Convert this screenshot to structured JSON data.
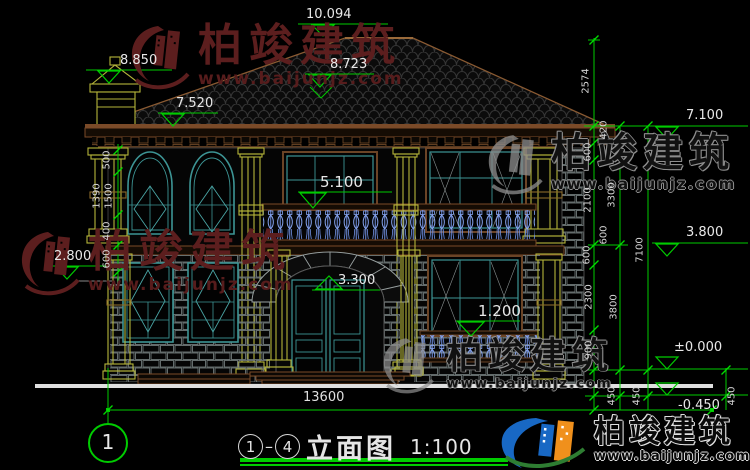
{
  "watermark": {
    "brand": "柏竣建筑",
    "url": "www.baijunjz.com"
  },
  "title": {
    "axis_from": "1",
    "axis_to": "4",
    "separator": "–",
    "name": "立面图",
    "scale": "1:100"
  },
  "axis_bubble": {
    "label": "1"
  },
  "elevations": {
    "ridge": "10.094",
    "chimney": "8.850",
    "roof_right": "8.723",
    "eave": "7.520",
    "balcony": "5.100",
    "arch": "3.300",
    "left_mid": "2.800",
    "window_sill": "1.200",
    "right_eave": "7.100",
    "right_floor2": "3.800",
    "ground": "±0.000",
    "grade": "-0.450"
  },
  "dimensions": {
    "total_width": "13600",
    "right": [
      "2574",
      "420",
      "600",
      "2100",
      "3300",
      "600",
      "7100",
      "600",
      "2300",
      "3800",
      "900",
      "450",
      "450",
      "450"
    ],
    "left": [
      "500",
      "1390",
      "1500",
      "400",
      "600"
    ]
  },
  "colors": {
    "dim_green": "#00cc00",
    "text_white": "#e8e8e8",
    "window_teal": "#3d9595",
    "column_yellow": "#b5b53a",
    "trim_brown": "#7a4a28",
    "stone_gray": "#6e7878",
    "baluster_blue": "#6f8fe0",
    "watermark_red": "#5c1e1e",
    "watermark_gray": "#8f8f8f",
    "logo_blue": "#1868c4",
    "logo_orange": "#f0901c",
    "logo_green": "#2e7d32"
  }
}
